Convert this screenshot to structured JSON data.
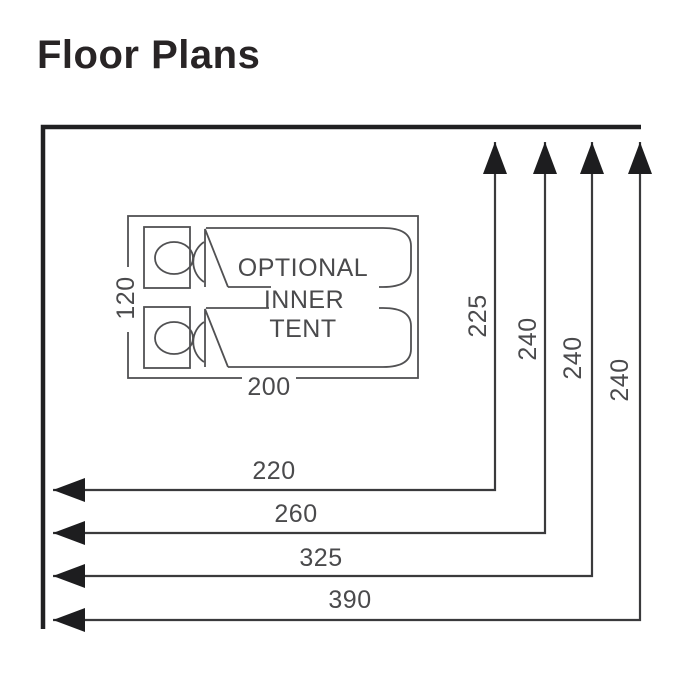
{
  "title": "Floor Plans",
  "diagram": {
    "type": "tent-floor-plan",
    "inner_tent": {
      "label_line1": "OPTIONAL",
      "label_line2": "INNER",
      "label_line3": "TENT",
      "width_label": "200",
      "depth_label": "120",
      "bed_count": 2
    },
    "dimensions": {
      "vertical": [
        {
          "label": "225"
        },
        {
          "label": "240"
        },
        {
          "label": "240"
        },
        {
          "label": "240"
        }
      ],
      "horizontal": [
        {
          "label": "220"
        },
        {
          "label": "260"
        },
        {
          "label": "325"
        },
        {
          "label": "390"
        }
      ]
    },
    "colors": {
      "wall": "#202022",
      "outline": "#515153",
      "dimension_line": "#3a3a3c",
      "arrowhead": "#1d1d1f",
      "label_text": "#4a4a4c",
      "title_text": "#282425",
      "background": "#ffffff"
    }
  }
}
